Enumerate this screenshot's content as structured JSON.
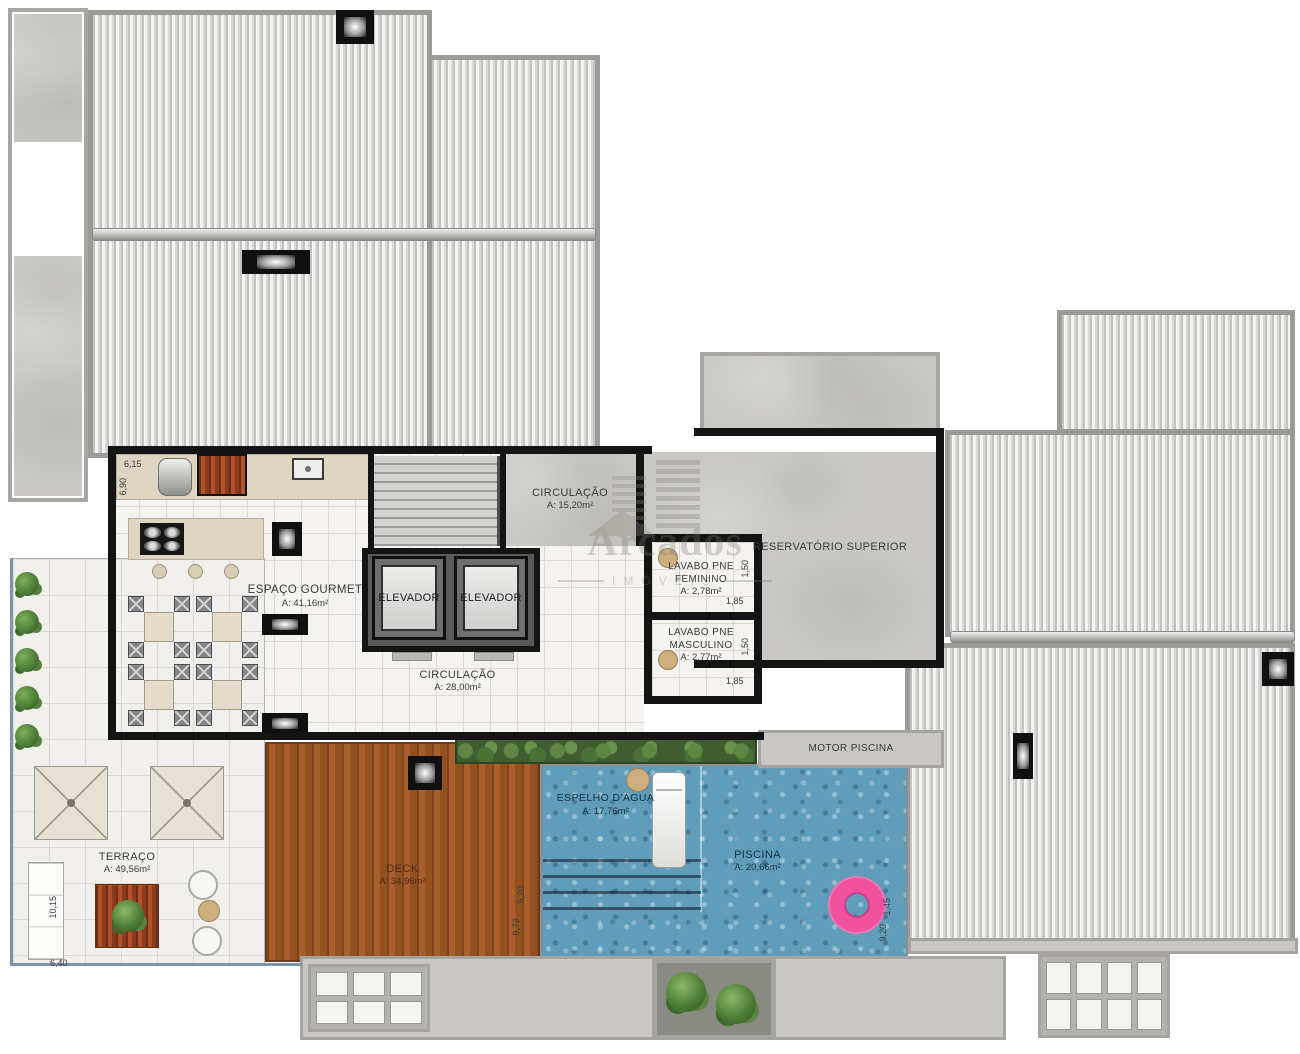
{
  "watermark": {
    "brand": "Arcados",
    "subtitle": "IMÓVEIS"
  },
  "labels": {
    "circulacao_top": {
      "name": "CIRCULAÇÃO",
      "area": "A: 15,20m²"
    },
    "circulacao_main": {
      "name": "CIRCULAÇÃO",
      "area": "A: 28,00m²"
    },
    "espaco_gourmet": {
      "name": "ESPAÇO GOURMET",
      "area": "A: 41,16m²"
    },
    "elevador": "ELEVADOR",
    "lavabo_fem": {
      "line1": "LAVABO PNE",
      "line2": "FEMININO",
      "area": "A: 2,78m²"
    },
    "lavabo_masc": {
      "line1": "LAVABO PNE",
      "line2": "MASCULINO",
      "area": "A: 2,77m²"
    },
    "reservatorio": "RESERVATÓRIO SUPERIOR",
    "motor_piscina": "MOTOR PISCINA",
    "espelho": {
      "name": "ESPELHO D'ÁGUA",
      "area": "A: 17,76m²"
    },
    "piscina": {
      "name": "PISCINA",
      "area": "A: 20,66m²"
    },
    "deck": {
      "name": "DECK",
      "area": "A: 34,96m²"
    },
    "terraco": {
      "name": "TERRAÇO",
      "area": "A: 49,56m²"
    }
  },
  "dimensions": {
    "gourmet_width": "6,15",
    "gourmet_height": "6,90",
    "lavabo_fem_depth": "1,50",
    "lavabo_fem_width": "1,85",
    "lavabo_masc_depth": "1,50",
    "lavabo_masc_width": "1,85",
    "terraco_height": "10,15",
    "terraco_width": "6,40",
    "deck_right_upper": "5,20",
    "deck_right_lower": "9,73",
    "pool_right_upper": "1,45",
    "pool_right_lower": "9,20"
  },
  "colors": {
    "pool": "#5f9dbb",
    "deck": "#a85f2c",
    "wall": "#141414",
    "roof_stripe": "#c2c2c0",
    "concrete": "#c9c8c4",
    "float_ring": "#f2519f"
  }
}
